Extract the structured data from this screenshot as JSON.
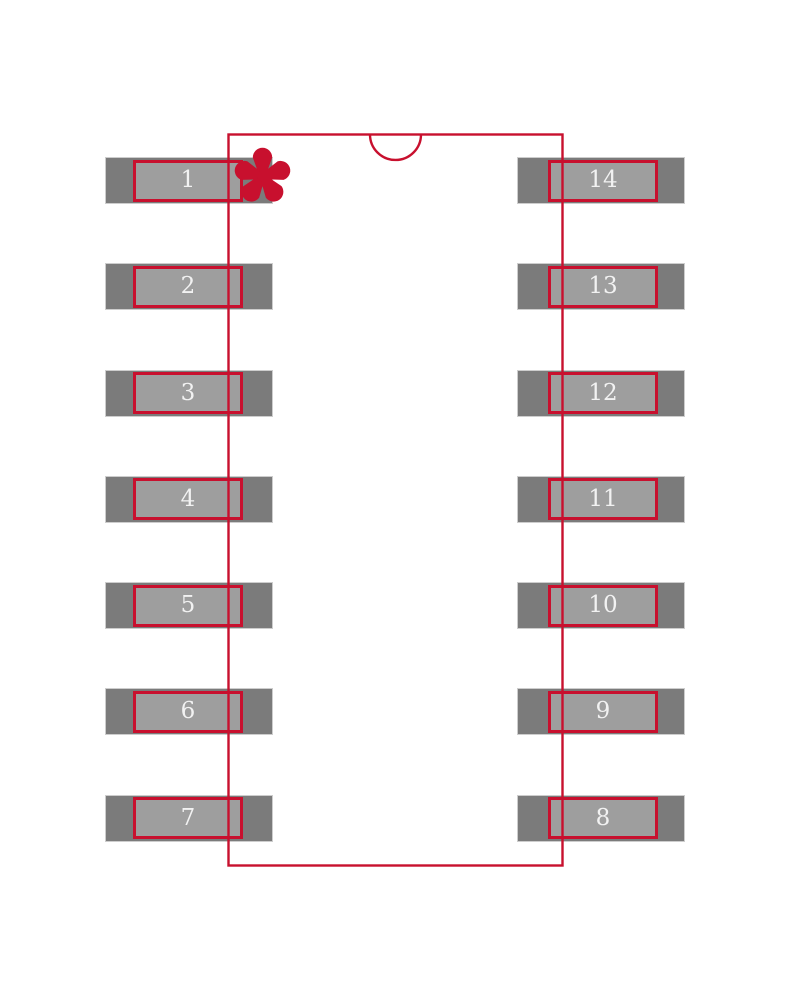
{
  "diagram": {
    "kind": "component-footprint-land-pattern",
    "pin1_marker": "asterisk",
    "pads": {
      "left": [
        "1",
        "2",
        "3",
        "4",
        "5",
        "6",
        "7"
      ],
      "right": [
        "14",
        "13",
        "12",
        "11",
        "10",
        "9",
        "8"
      ]
    }
  },
  "colors": {
    "background": "#FFFFFF",
    "outline_red": "#C8102E",
    "pad_outer_gray": "#7B7B7B",
    "pad_inner_gray": "#9E9E9E",
    "pad_edge_light": "#CDCDCD",
    "pad_number_text": "#F2F2F2"
  }
}
